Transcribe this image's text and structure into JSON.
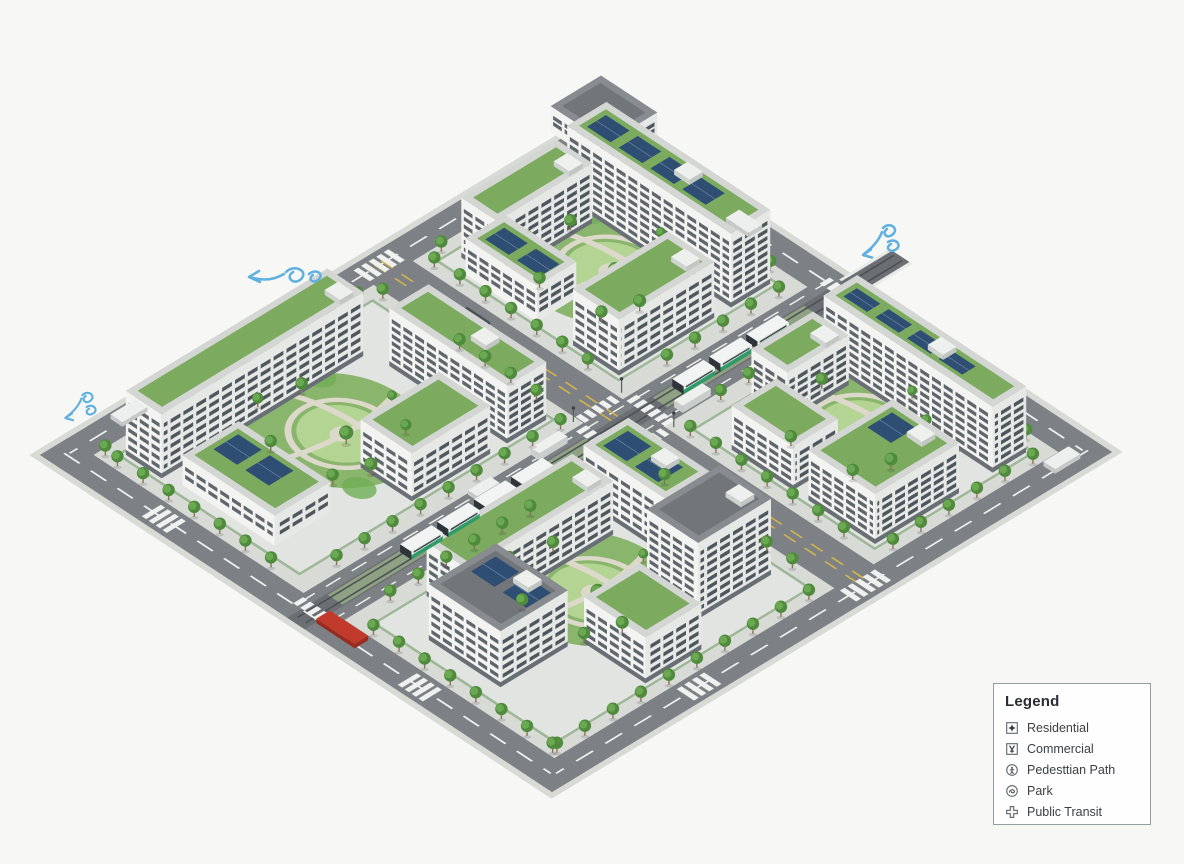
{
  "legend": {
    "title": "Legend",
    "items": [
      {
        "label": "Residential",
        "icon": "residential-icon"
      },
      {
        "label": "Commercial",
        "icon": "commercial-icon"
      },
      {
        "label": "Pedesttian Path",
        "icon": "pedestrian-path-icon"
      },
      {
        "label": "Park",
        "icon": "park-icon"
      },
      {
        "label": "Public Transit",
        "icon": "public-transit-icon"
      }
    ]
  },
  "scene": {
    "type": "isometric-sustainable-city-district",
    "superblocks": 4,
    "wind_indicators": 3,
    "transit_trains": 2,
    "features": [
      "green roofs",
      "rooftop solar panels",
      "courtyard parks",
      "street trees",
      "light rail corridor",
      "pedestrian crosswalks",
      "perimeter ring road"
    ]
  },
  "colors": {
    "background": "#f7f8f6",
    "sidewalk": "#d8dad6",
    "road": "#7d8186",
    "block": "#e1e4e0",
    "marking_white": "#eff1ef",
    "marking_yellow": "#d5b54a",
    "park": "#8ab56c",
    "lawn": "#b3d492",
    "path": "#dcd8ca",
    "tree": "#4f8a3d",
    "tree_light": "#6fae55",
    "tree_dark": "#3c7330",
    "trunk": "#8a7355",
    "wall": "#f3f4f2",
    "wall_side": "#e6e8e6",
    "wall_base": "#596067",
    "window": "#39424a",
    "roof_edge": "#d3d6d2",
    "roof_green": "#7cab60",
    "roof_gray": "#888c90",
    "roof_gray_dark": "#72767a",
    "solar": "#2f4e74",
    "rail": "#4b5054",
    "track_bed": "#6b6f74",
    "train_white": "#f2f4f3",
    "train_green": "#2f9b68",
    "train_dark": "#2e343a",
    "bus_red": "#c23a2c",
    "car_white": "#edefee",
    "car_dark": "#4a5056",
    "wind": "#5fb0de",
    "legend_bg": "#fefefe",
    "legend_border": "#979ca0",
    "text_dark": "#2a2e33",
    "text": "#3a4046",
    "icon_stroke": "#60666c",
    "icon_dark": "#39414a"
  }
}
